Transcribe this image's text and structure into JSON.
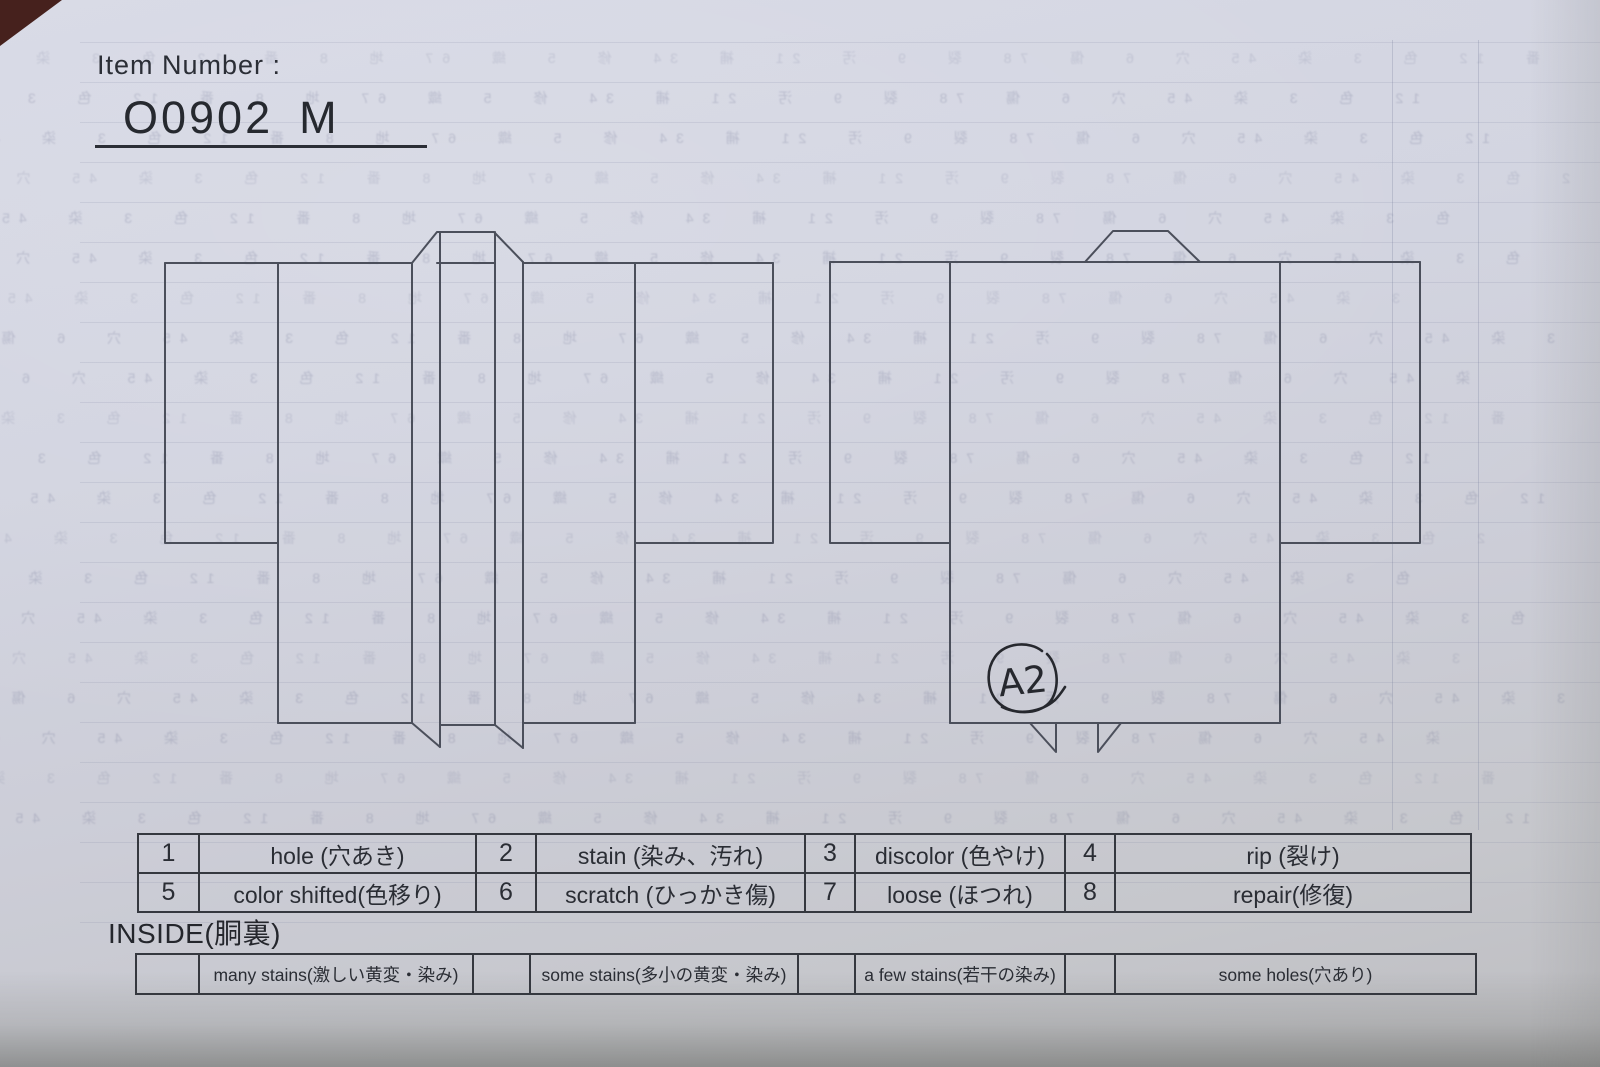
{
  "header": {
    "item_number_label": "Item Number :",
    "item_number_value": "O0902",
    "item_number_size": "M"
  },
  "annotation": {
    "handwritten_mark": "A2"
  },
  "legend": {
    "rows": [
      [
        {
          "code": "1",
          "label": "hole (穴あき)"
        },
        {
          "code": "2",
          "label": "stain (染み、汚れ)"
        },
        {
          "code": "3",
          "label": "discolor (色やけ)"
        },
        {
          "code": "4",
          "label": "rip (裂け)"
        }
      ],
      [
        {
          "code": "5",
          "label": "color shifted(色移り)"
        },
        {
          "code": "6",
          "label": "scratch (ひっかき傷)"
        },
        {
          "code": "7",
          "label": "loose (ほつれ)"
        },
        {
          "code": "8",
          "label": "repair(修復)"
        }
      ]
    ]
  },
  "inside": {
    "title": "INSIDE(胴裏)",
    "options": [
      "many stains(激しい黄変・染み)",
      "some stains(多小の黄変・染み)",
      "a few stains(若干の染み)",
      "some holes(穴あり)"
    ]
  },
  "colors": {
    "paper": "#d1d3df",
    "ink": "#2a2d34",
    "outline": "#4b4f5b",
    "table_border": "#35383f",
    "surface_corner": "#46211d"
  },
  "show_through": {
    "description": "illegible mirrored print showing through from reverse side",
    "texture_glyphs": "番 12 色 3 染 45 穴 6 傷 78 裂 9 汚 21 補 34 修 5 織 67 地 8"
  }
}
